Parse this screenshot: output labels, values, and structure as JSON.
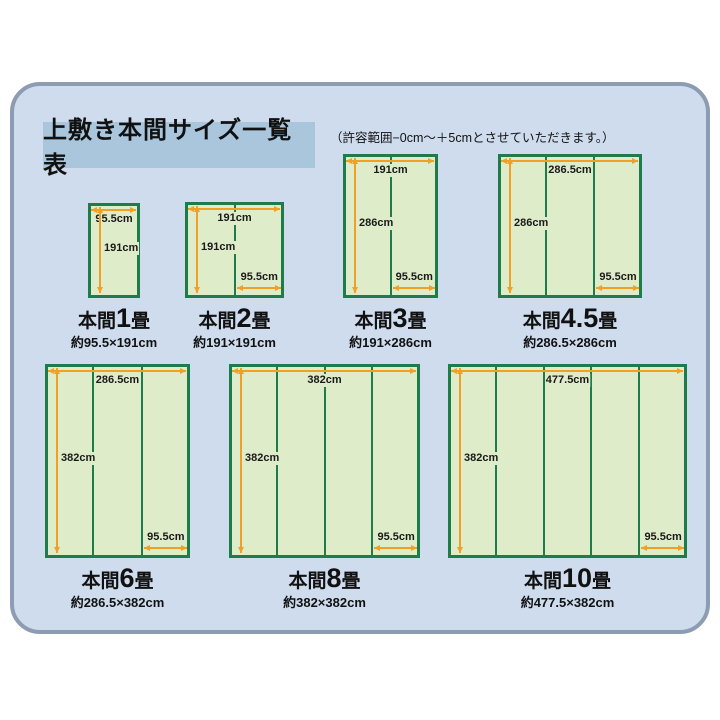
{
  "page": {
    "title": "上敷き本間サイズ一覧表",
    "note": "（許容範囲−0cm～＋5cmとさせていただきます。）"
  },
  "colors": {
    "panel_bg": "#cfdcee",
    "panel_border": "#8c9cb2",
    "title_bg": "#a9c6dc",
    "mat_fill": "#dfecca",
    "mat_border": "#1e7b4a",
    "arrow": "#f0a125"
  },
  "diagrams": [
    {
      "name_prefix": "本間",
      "name_num": "1",
      "name_suffix": "畳",
      "size_label": "約95.5×191cm",
      "width_label": "95.5cm",
      "height_label": "191cm",
      "panel_label": null,
      "panels": 1,
      "rect": {
        "x": 88,
        "y": 203,
        "w": 52,
        "h": 95
      }
    },
    {
      "name_prefix": "本間",
      "name_num": "2",
      "name_suffix": "畳",
      "size_label": "約191×191cm",
      "width_label": "191cm",
      "height_label": "191cm",
      "panel_label": "95.5cm",
      "panels": 2,
      "rect": {
        "x": 185,
        "y": 202,
        "w": 99,
        "h": 96
      }
    },
    {
      "name_prefix": "本間",
      "name_num": "3",
      "name_suffix": "畳",
      "size_label": "約191×286cm",
      "width_label": "191cm",
      "height_label": "286cm",
      "panel_label": "95.5cm",
      "panels": 2,
      "rect": {
        "x": 343,
        "y": 154,
        "w": 95,
        "h": 144
      }
    },
    {
      "name_prefix": "本間",
      "name_num": "4.5",
      "name_suffix": "畳",
      "size_label": "約286.5×286cm",
      "width_label": "286.5cm",
      "height_label": "286cm",
      "panel_label": "95.5cm",
      "panels": 3,
      "rect": {
        "x": 498,
        "y": 154,
        "w": 144,
        "h": 144
      }
    },
    {
      "name_prefix": "本間",
      "name_num": "6",
      "name_suffix": "畳",
      "size_label": "約286.5×382cm",
      "width_label": "286.5cm",
      "height_label": "382cm",
      "panel_label": "95.5cm",
      "panels": 3,
      "rect": {
        "x": 45,
        "y": 364,
        "w": 145,
        "h": 194
      }
    },
    {
      "name_prefix": "本間",
      "name_num": "8",
      "name_suffix": "畳",
      "size_label": "約382×382cm",
      "width_label": "382cm",
      "height_label": "382cm",
      "panel_label": "95.5cm",
      "panels": 4,
      "rect": {
        "x": 229,
        "y": 364,
        "w": 191,
        "h": 194
      }
    },
    {
      "name_prefix": "本間",
      "name_num": "10",
      "name_suffix": "畳",
      "size_label": "約477.5×382cm",
      "width_label": "477.5cm",
      "height_label": "382cm",
      "panel_label": "95.5cm",
      "panels": 5,
      "rect": {
        "x": 448,
        "y": 364,
        "w": 239,
        "h": 194
      }
    }
  ]
}
